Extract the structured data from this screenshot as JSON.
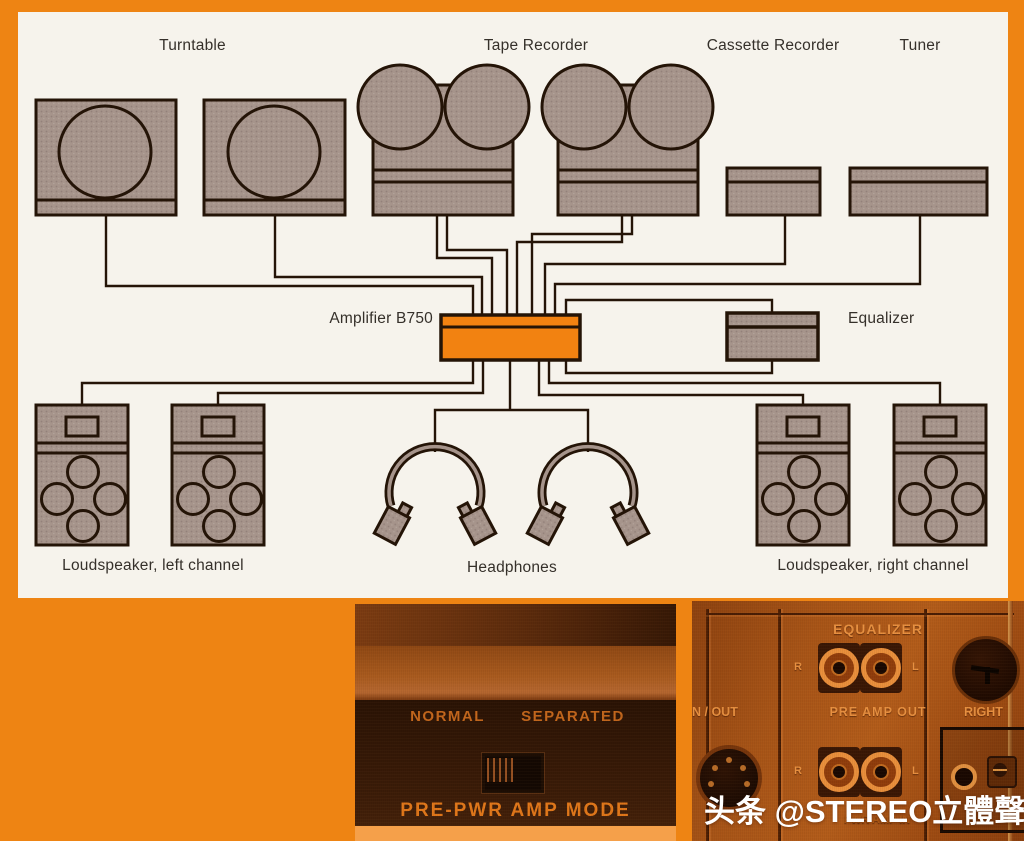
{
  "diagram": {
    "labels": {
      "turntable": "Turntable",
      "tape_recorder": "Tape Recorder",
      "cassette_recorder": "Cassette Recorder",
      "tuner": "Tuner",
      "amplifier": "Amplifier B750",
      "equalizer": "Equalizer",
      "loudspeaker_left": "Loudspeaker, left channel",
      "headphones": "Headphones",
      "loudspeaker_right": "Loudspeaker, right channel"
    }
  },
  "switch_photo": {
    "normal": "NORMAL",
    "separated": "SEPARATED",
    "caption": "PRE-PWR AMP MODE",
    "switch_position": "NORMAL"
  },
  "rear_panel": {
    "equalizer": "EQUALIZER",
    "pre_amp_out": "PRE AMP OUT",
    "pwr_amp_in": "PWR AMP IN",
    "in_out": "N / OUT",
    "right": "RIGHT",
    "r": "R",
    "l": "L"
  },
  "watermark": "头条 @STEREO立體聲",
  "colors": {
    "page_orange": "#ee8413",
    "panel_cream": "#f6f3ec",
    "component_fill": "#a6948b",
    "line_dark": "#241407",
    "amplifier_orange": "#f28211",
    "photo_caption_orange": "#e0771a",
    "rear_label_orange": "#e89040",
    "watermark_white": "#ffffff"
  }
}
